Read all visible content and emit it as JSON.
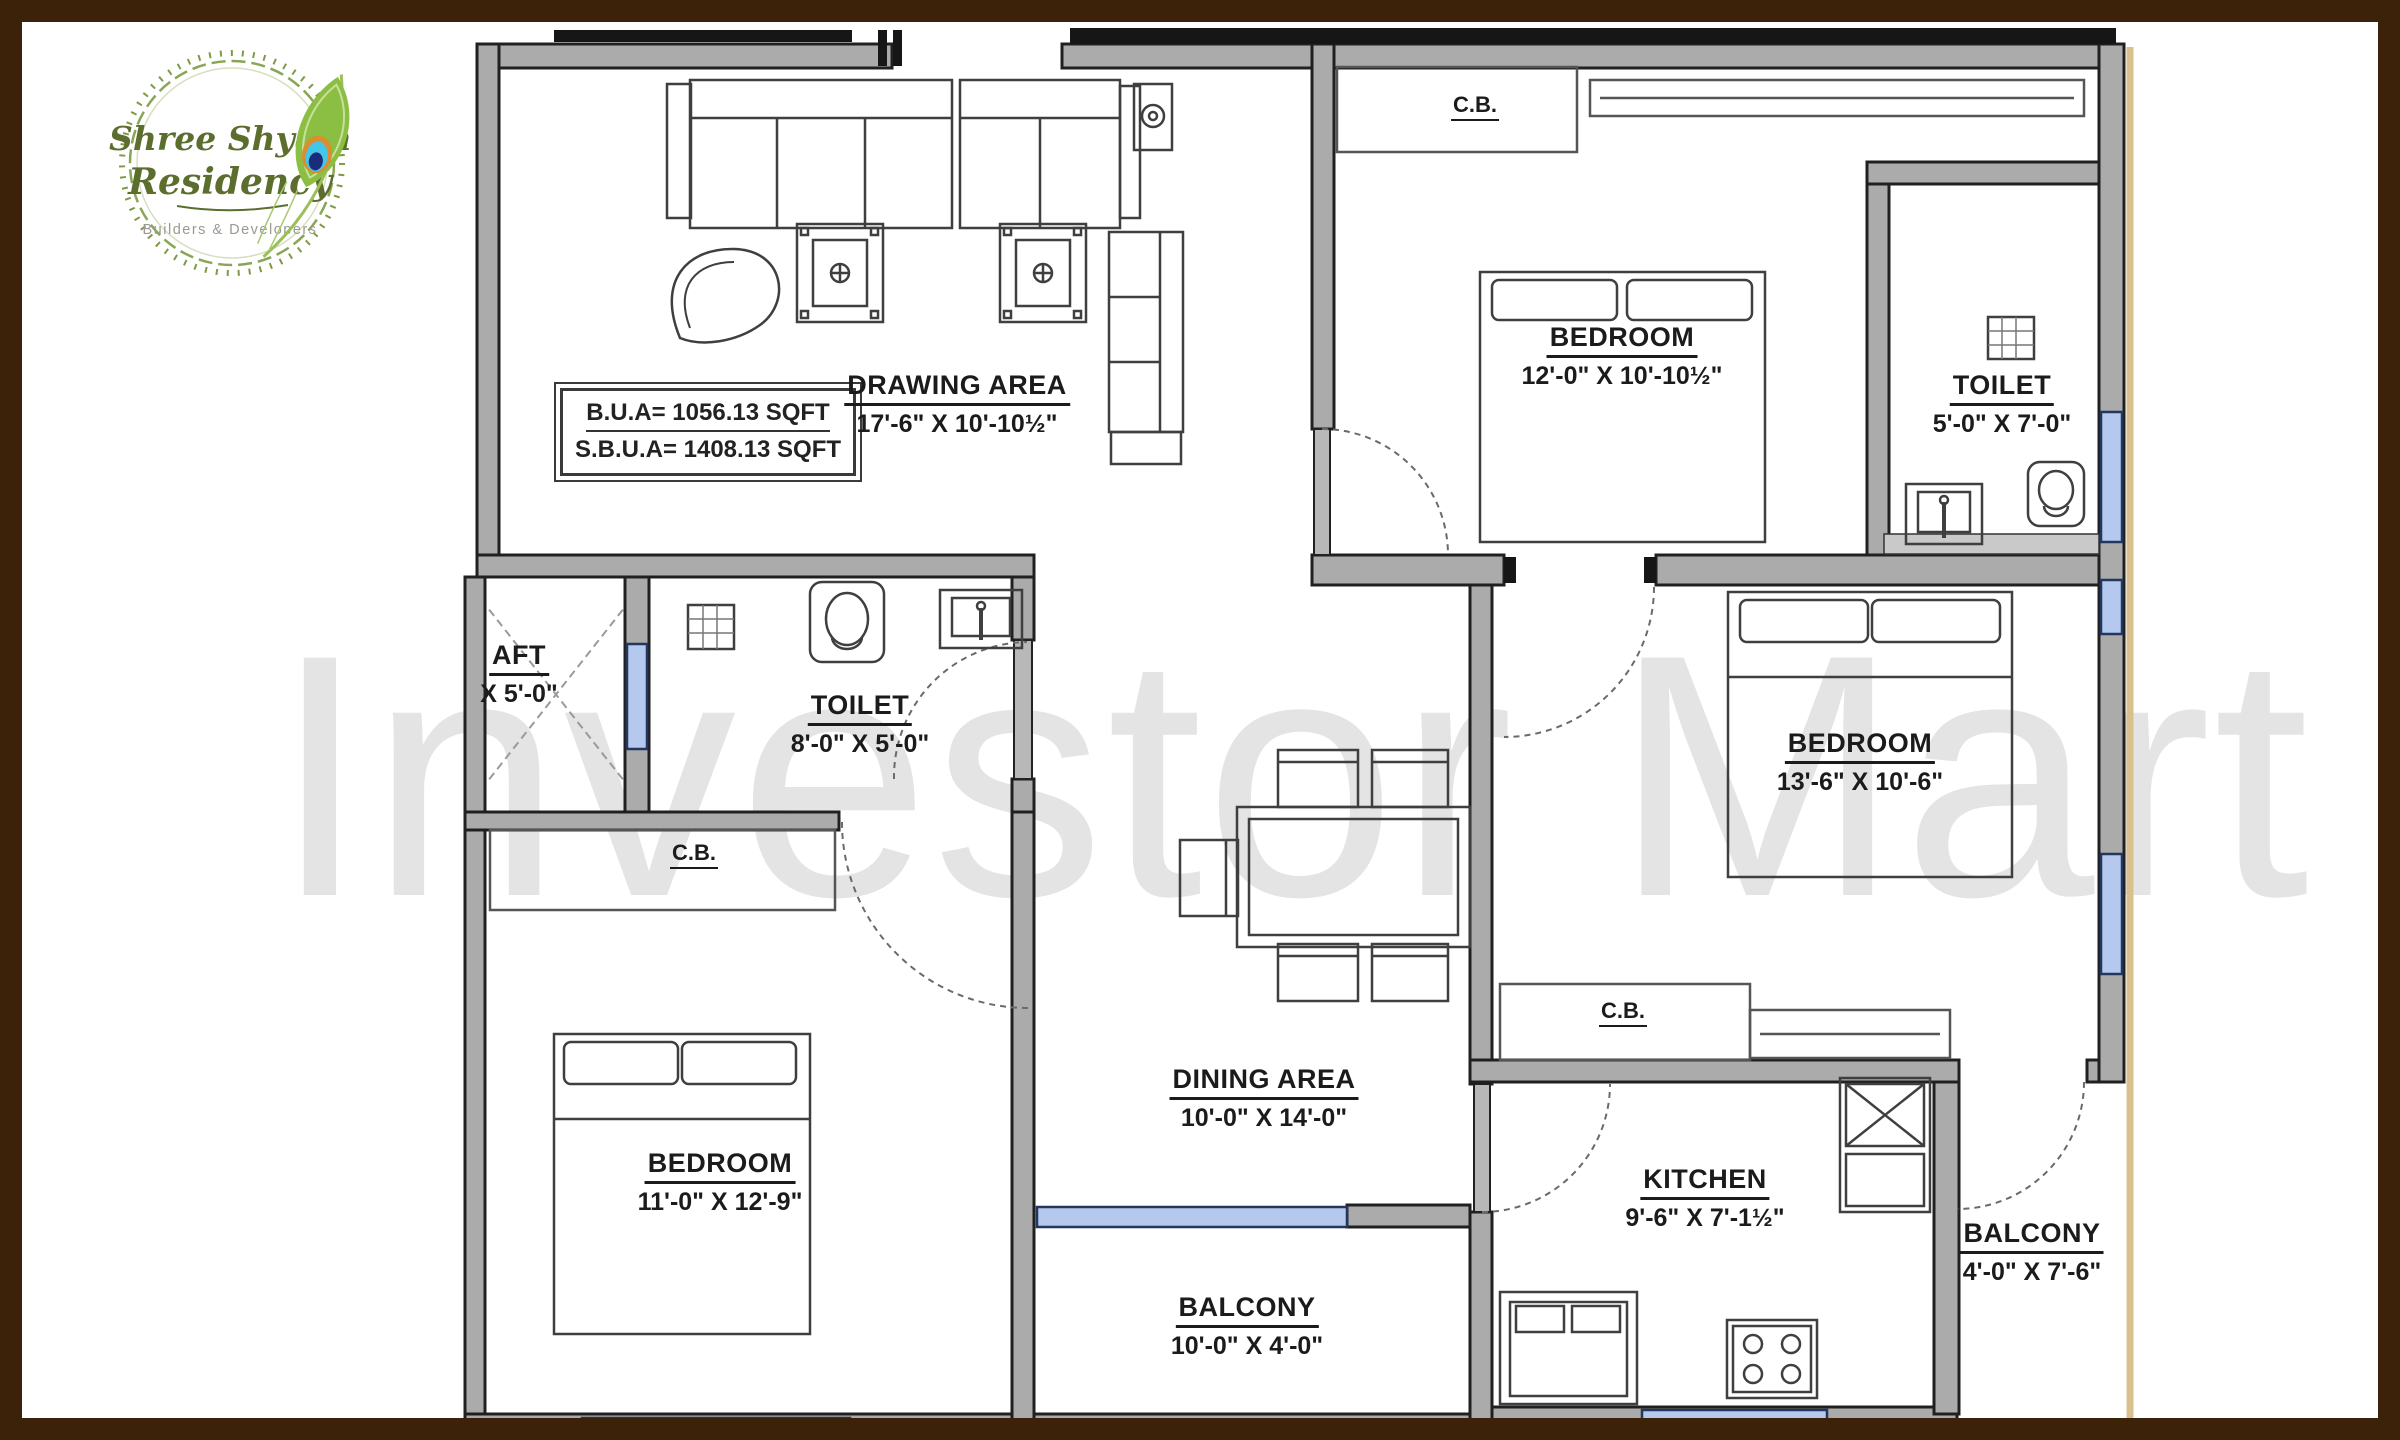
{
  "branding": {
    "name_line1": "Shree Shyam",
    "name_line2": "Residency",
    "tagline": "Builders & Developers"
  },
  "watermark": "Investor Mart",
  "area_box": {
    "line1": "B.U.A= 1056.13 SQFT",
    "line2": "S.B.U.A= 1408.13 SQFT"
  },
  "labels": {
    "cupboard": "C.B."
  },
  "rooms": [
    {
      "id": "drawing-area",
      "name": "DRAWING AREA",
      "dims": "17'-6\" X 10'-10½\""
    },
    {
      "id": "bedroom-top-right",
      "name": "BEDROOM",
      "dims": "12'-0\" X 10'-10½\""
    },
    {
      "id": "toilet-top-right",
      "name": "TOILET",
      "dims": "5'-0\" X 7'-0\""
    },
    {
      "id": "shaft",
      "name": "AFT",
      "dims": "X 5'-0\""
    },
    {
      "id": "toilet-middle",
      "name": "TOILET",
      "dims": "8'-0\" X 5'-0\""
    },
    {
      "id": "bedroom-right",
      "name": "BEDROOM",
      "dims": "13'-6\" X 10'-6\""
    },
    {
      "id": "bedroom-bottom-left",
      "name": "BEDROOM",
      "dims": "11'-0\" X 12'-9\""
    },
    {
      "id": "dining-area",
      "name": "DINING AREA",
      "dims": "10'-0\" X 14'-0\""
    },
    {
      "id": "kitchen",
      "name": "KITCHEN",
      "dims": "9'-6\" X 7'-1½\""
    },
    {
      "id": "balcony-right",
      "name": "BALCONY",
      "dims": "4'-0\" X 7'-6\""
    },
    {
      "id": "balcony-bottom",
      "name": "BALCONY",
      "dims": "10'-0\" X 4'-0\""
    }
  ],
  "colors": {
    "frame": "#3b2208",
    "wall_fill": "#ababab",
    "wall_edge": "#202020",
    "window": "#b5c9ef",
    "window_edge": "#23365c",
    "plot_boundary": "#d9c18f",
    "watermark": "#e4e4e4",
    "logo_green": "#8abf43",
    "logo_text": "#5c6e2e",
    "feather_eye_blue": "#45c6e8",
    "feather_eye_navy": "#1b2d7a"
  }
}
